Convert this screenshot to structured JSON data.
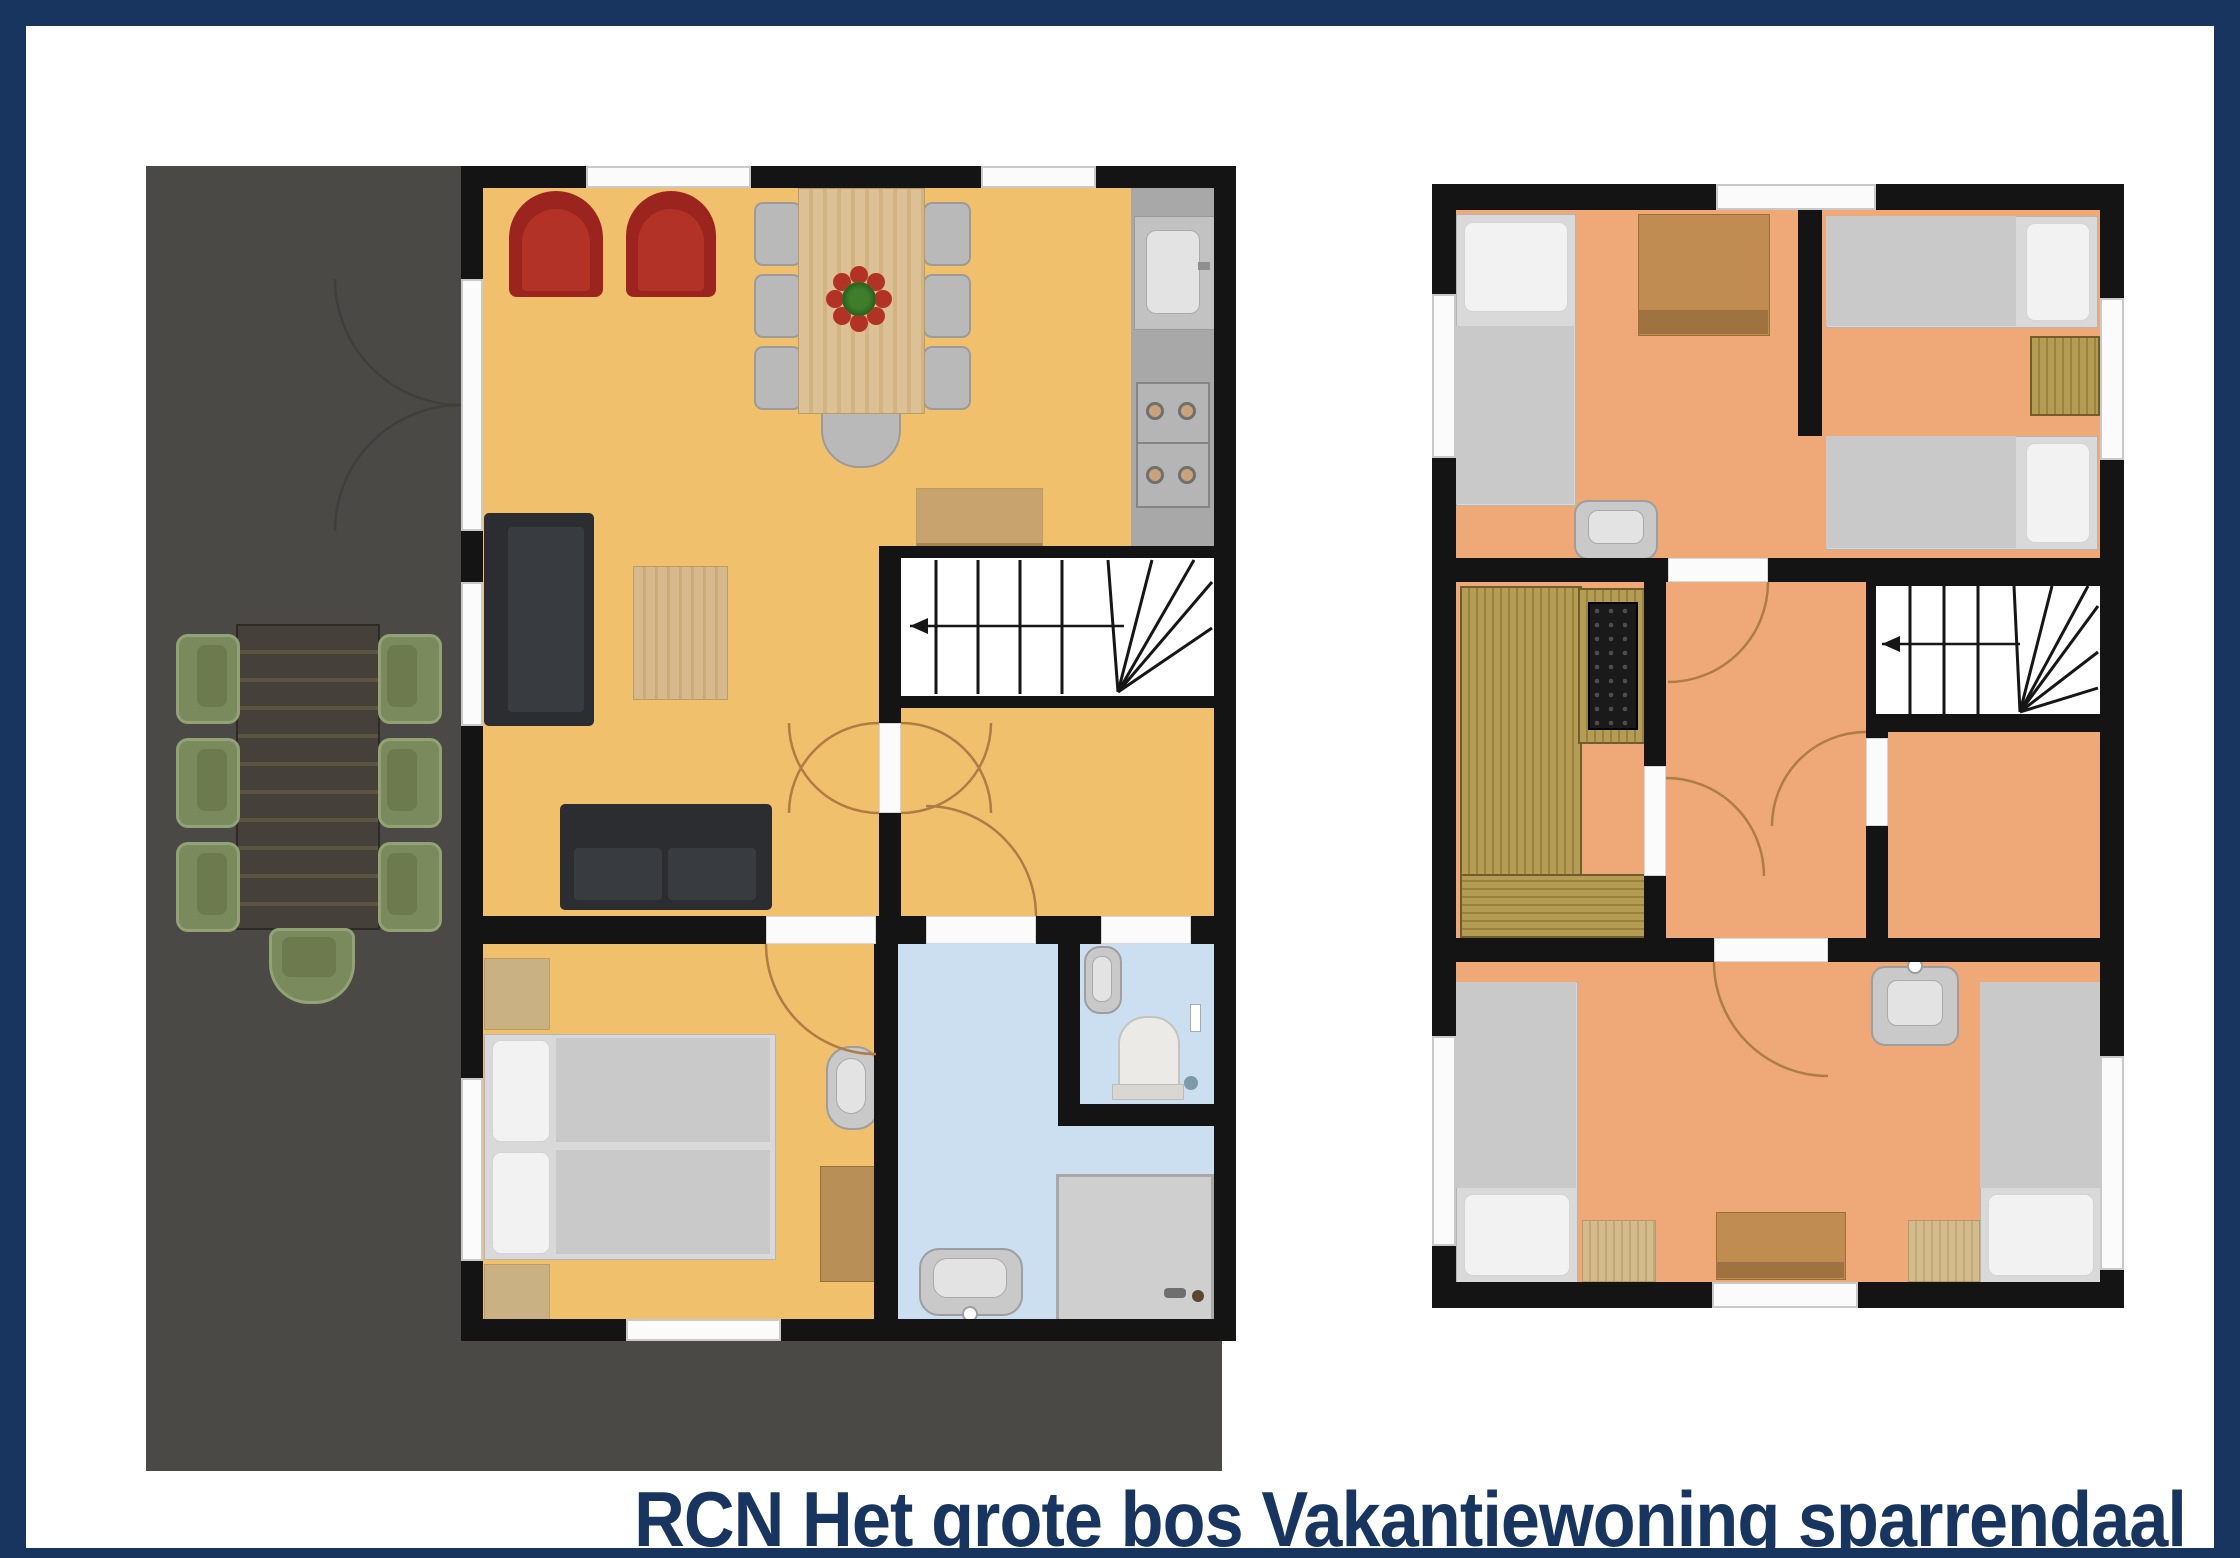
{
  "title": {
    "text": "RCN Het grote bos Vakantiewoning sparrendaal",
    "color": "#17355e"
  },
  "page": {
    "background": "#ffffff",
    "frame_color": "#17355e"
  },
  "palette": {
    "wall": "#141414",
    "terrace_gray": "#4a4946",
    "ground_floor": "#f1c06c",
    "upper_floor": "#efa877",
    "bathroom_blue": "#cbdff0",
    "door_arc": "#ad7d45",
    "wood_light": "#d6b98c",
    "dresser_brown": "#c08c52",
    "sauna_wood": "#b49c54",
    "sofa_dark": "#2b2d30",
    "armchair_red": "#9c241f",
    "outdoor_chair_green": "#7b8a5c",
    "mattress_gray": "#c9c9c9",
    "kitchen_counter": "#a8a8a8"
  },
  "plans": [
    {
      "position": "left",
      "level_elements": [
        "terrace",
        "outdoor-dining-set",
        "living-room",
        "dining-table",
        "kitchen",
        "stairs",
        "bedroom",
        "bathroom",
        "wc",
        "shower"
      ]
    },
    {
      "position": "right",
      "level_elements": [
        "bedroom-left",
        "bedroom-right",
        "sauna",
        "hallway",
        "stairs",
        "bedroom-bottom",
        "washbasins"
      ]
    }
  ]
}
